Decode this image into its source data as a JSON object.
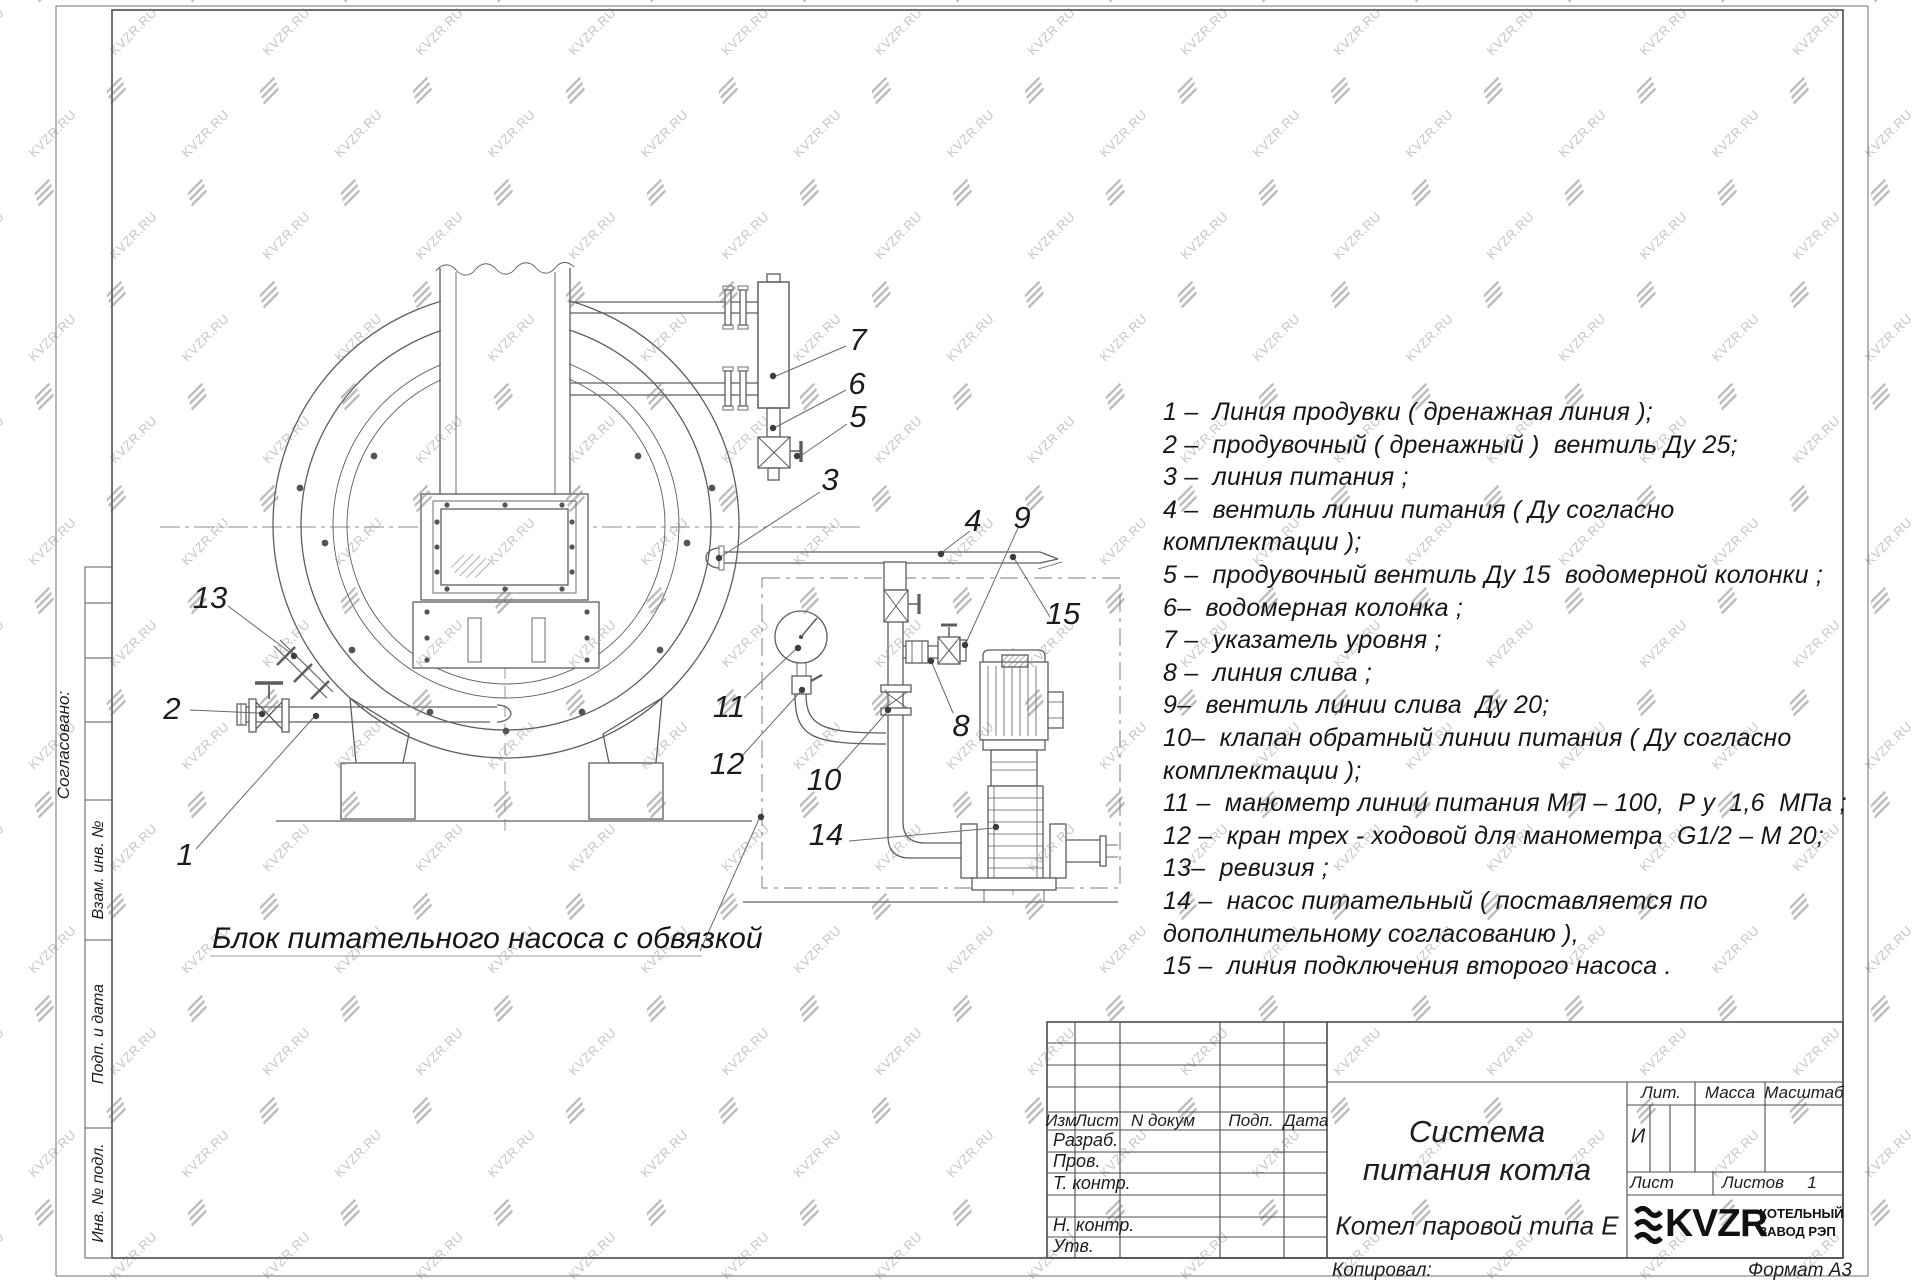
{
  "watermark": {
    "text": "KVZR.RU"
  },
  "legend": {
    "rows": [
      "1 –  Линия продувки ( дренажная линия );",
      "2 –  продувочный ( дренажный )  вентиль Ду 25;",
      "3 –  линия питания ;",
      "4 –  вентиль линии питания ( Ду согласно",
      "комплектации );",
      "5 –  продувочный вентиль Ду 15  водомерной колонки ;",
      "6–  водомерная колонка ;",
      "7 –  указатель уровня ;",
      "8 –  линия слива ;",
      "9–  вентиль линии слива  Ду 20;",
      "10–  клапан обратный линии питания ( Ду согласно",
      "комплектации );",
      "11 –  манометр линии питания МП – 100,  Р у  1,6  МПа ;",
      "12 –  кран трех - ходовой для манометра  G1/2 – М 20;",
      "13–  ревизия ;",
      "14 –  насос питательный ( поставляется по",
      "дополнительному согласованию ),",
      "15 –  линия подключения второго насоса ."
    ]
  },
  "drawing": {
    "block_label": "Блок питательного насоса с обвязкой",
    "callouts": {
      "1": "1",
      "2": "2",
      "3": "3",
      "4": "4",
      "5": "5",
      "6": "6",
      "7": "7",
      "8": "8",
      "9": "9",
      "10": "10",
      "11": "11",
      "12": "12",
      "13": "13",
      "14": "14",
      "15": "15"
    }
  },
  "stamp": {
    "rev_header": {
      "izm": "Изм",
      "list": "Лист",
      "ndoc": "N докум",
      "podp": "Подп.",
      "data": "Дата"
    },
    "staff": [
      "Разраб.",
      "Пров.",
      "Т. контр.",
      "",
      "Н. контр.",
      "Утв."
    ],
    "title_line1": "Система",
    "title_line2": "питания котла",
    "subtitle": "Котел паровой типа Е",
    "lit_label": "Лит.",
    "massa_label": "Масса",
    "masshtab_label": "Масштаб",
    "lit_value": "И",
    "list_label": "Лист",
    "listov_label": "Листов",
    "listov_value": "1",
    "logo_text": "KVZR",
    "logo_caption1": "КОТЕЛЬНЫЙ",
    "logo_caption2": "ЗАВОД РЭП",
    "kopiroval": "Копировал:",
    "format": "Формат А3"
  },
  "margin": {
    "soglasovano": "Согласовано:",
    "vzam": "Взам. инв. №",
    "podp_data": "Подп. и дата",
    "inv_podl": "Инв. № подл."
  }
}
